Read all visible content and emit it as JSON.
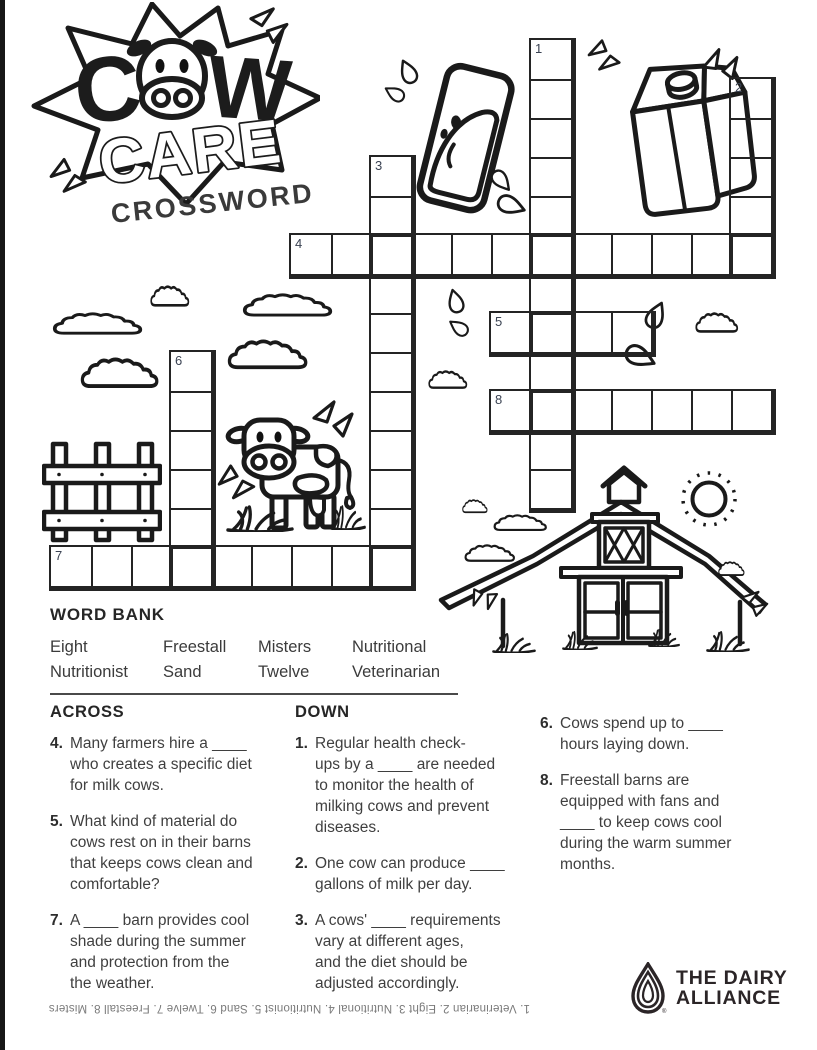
{
  "logo": {
    "c": "C",
    "w": "W",
    "care": "CARE",
    "subtitle": "CROSSWORD"
  },
  "grid": {
    "words": [
      {
        "number": "1",
        "direction": "down",
        "x": 531,
        "y": 40,
        "length": 12
      },
      {
        "number": "2",
        "direction": "down",
        "x": 731,
        "y": 79,
        "length": 5
      },
      {
        "number": "3",
        "direction": "down",
        "x": 371,
        "y": 157,
        "length": 11
      },
      {
        "number": "4",
        "direction": "across",
        "x": 291,
        "y": 235,
        "length": 12
      },
      {
        "number": "5",
        "direction": "across",
        "x": 491,
        "y": 313,
        "length": 4
      },
      {
        "number": "6",
        "direction": "down",
        "x": 171,
        "y": 352,
        "length": 6
      },
      {
        "number": "7",
        "direction": "across",
        "x": 51,
        "y": 547,
        "length": 9
      },
      {
        "number": "8",
        "direction": "across",
        "x": 491,
        "y": 391,
        "length": 7
      }
    ]
  },
  "word_bank": {
    "title": "WORD BANK",
    "rows": [
      [
        "Eight",
        "Freestall",
        "Misters",
        "Nutritional"
      ],
      [
        "Nutritionist",
        "Sand",
        "Twelve",
        "Veterinarian"
      ]
    ]
  },
  "clues": {
    "columns": [
      {
        "heading": "ACROSS",
        "items": [
          {
            "number": "4.",
            "text": "Many farmers hire a ____\nwho creates a specific diet\nfor milk cows."
          },
          {
            "number": "5.",
            "text": "What kind of material do\ncows rest on in their barns\nthat keeps cows clean and\ncomfortable?"
          },
          {
            "number": "7.",
            "text": "A ____ barn provides cool\nshade during the summer\nand protection from the\nthe weather."
          }
        ]
      },
      {
        "heading": "DOWN",
        "items": [
          {
            "number": "1.",
            "text": "Regular health check-\nups by a ____ are needed\nto monitor the health of\nmilking cows and prevent\ndiseases."
          },
          {
            "number": "2.",
            "text": "One cow can produce ____\ngallons of milk per day."
          },
          {
            "number": "3.",
            "text": "A cows' ____ requirements\nvary at different ages,\nand the diet should be\nadjusted accordingly."
          }
        ]
      },
      {
        "heading": "",
        "items": [
          {
            "number": "6.",
            "text": "Cows spend up to ____\nhours laying down."
          },
          {
            "number": "8.",
            "text": "Freestall barns are\nequipped with fans and\n____ to keep cows cool\nduring the warm summer\nmonths."
          }
        ]
      }
    ]
  },
  "answer_key": "1. Veterinarian 2. Eight 3. Nutritional 4. Nutritionist 5. Sand 6. Twelve 7. Freestall 8. Misters",
  "footer_logo": {
    "line1": "THE DAIRY",
    "line2": "ALLIANCE",
    "registered": "®"
  }
}
